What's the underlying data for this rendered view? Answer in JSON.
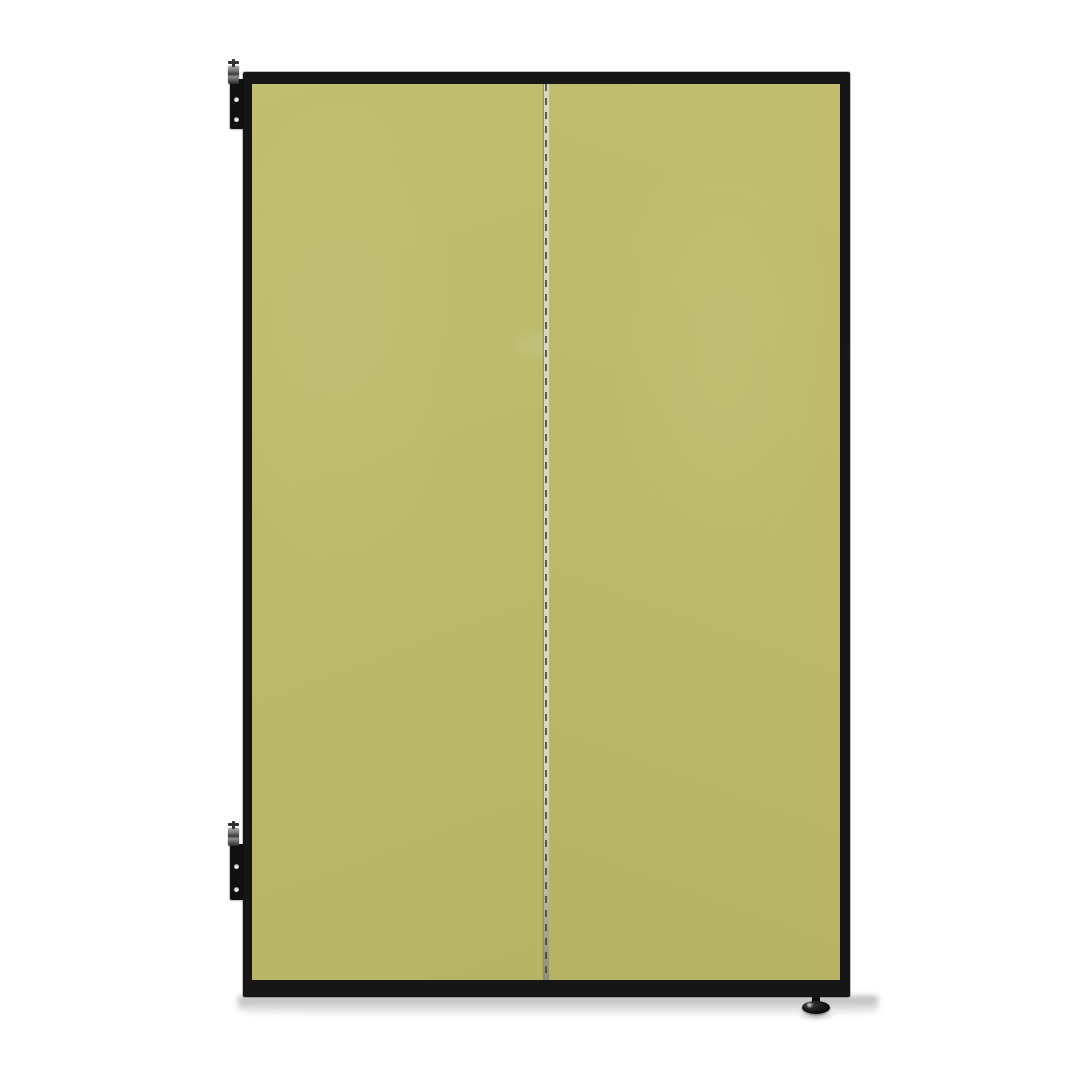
{
  "image": {
    "kind": "product-photo",
    "subject": "two-panel folding partition with black metal frame, chartreuse fabric panels, wall-mount hinge brackets on the left and a leveling foot at the bottom right",
    "visible_text": ""
  },
  "colors": {
    "background": "#ffffff",
    "frame": "#161616",
    "panel": "#bebc69",
    "panel_shade": "#b1ae5c",
    "seam_light": "#d7d6cc",
    "seam_dark": "#45453e",
    "bracket": "#101010",
    "pin_metal": "#a9a9a9",
    "hole": "#f2f2ee",
    "foot": "#0d0d0d",
    "shadow": "rgba(0,0,0,0.30)"
  },
  "parts": [
    {
      "name": "frame",
      "label": "black metal frame"
    },
    {
      "name": "left-panel",
      "label": "left fabric panel"
    },
    {
      "name": "right-panel",
      "label": "right fabric panel"
    },
    {
      "name": "piano-hinge-seam",
      "label": "center piano hinge"
    },
    {
      "name": "wall-bracket-top",
      "label": "upper wall-mount hinge bracket"
    },
    {
      "name": "wall-bracket-bottom",
      "label": "lower wall-mount hinge bracket"
    },
    {
      "name": "hinge-pin-top",
      "label": "upper hinge pin"
    },
    {
      "name": "hinge-pin-bottom",
      "label": "lower hinge pin"
    },
    {
      "name": "leveling-foot",
      "label": "adjustable leveling foot"
    },
    {
      "name": "floor-shadow",
      "label": "drop shadow"
    }
  ]
}
